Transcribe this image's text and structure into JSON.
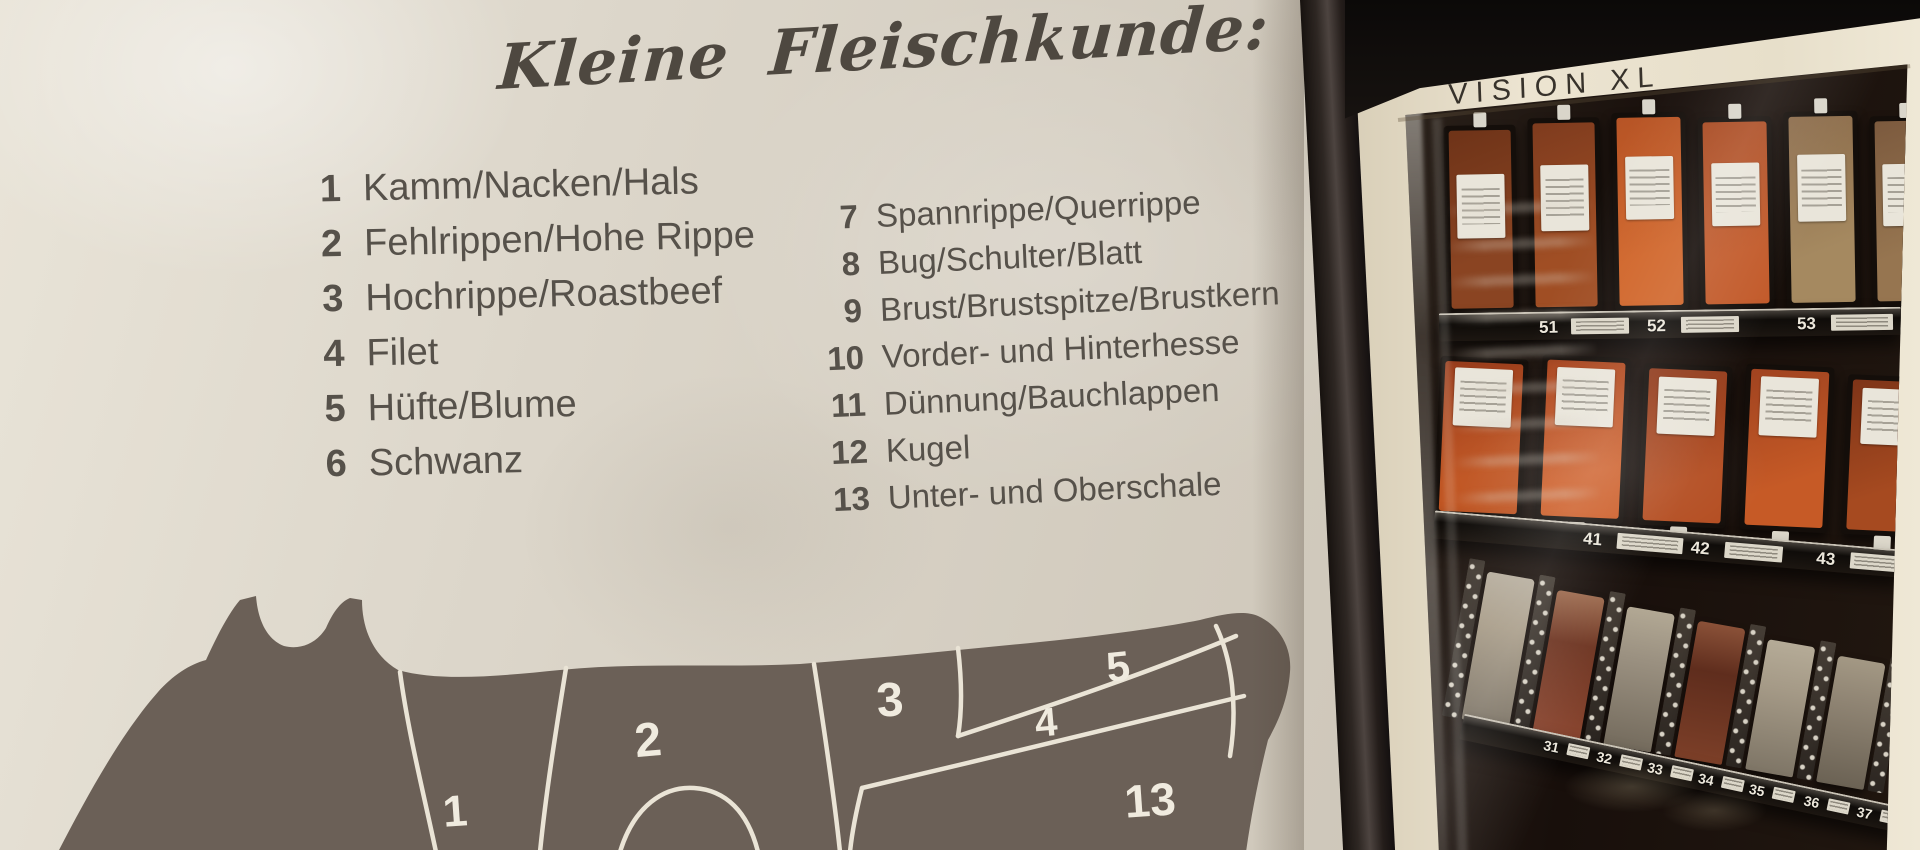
{
  "poster": {
    "title": "Kleine Fleischkunde:",
    "cuts_left": [
      {
        "num": "1",
        "label": "Kamm/Nacken/Hals"
      },
      {
        "num": "2",
        "label": "Fehlrippen/Hohe Rippe"
      },
      {
        "num": "3",
        "label": "Hochrippe/Roastbeef"
      },
      {
        "num": "4",
        "label": "Filet"
      },
      {
        "num": "5",
        "label": "Hüfte/Blume"
      },
      {
        "num": "6",
        "label": "Schwanz"
      }
    ],
    "cuts_right": [
      {
        "num": "7",
        "label": "Spannrippe/Querrippe"
      },
      {
        "num": "8",
        "label": "Bug/Schulter/Blatt"
      },
      {
        "num": "9",
        "label": "Brust/Brustspitze/Brustkern"
      },
      {
        "num": "10",
        "label": "Vorder- und Hinterhesse"
      },
      {
        "num": "11",
        "label": "Dünnung/Bauchlappen"
      },
      {
        "num": "12",
        "label": "Kugel"
      },
      {
        "num": "13",
        "label": "Unter- und Oberschale"
      }
    ],
    "diagram_labels": {
      "s1": "1",
      "s2": "2",
      "s3": "3",
      "s4": "4",
      "s5": "5",
      "s13": "13"
    }
  },
  "machine": {
    "brand": "VISION XL",
    "rows": [
      {
        "slots": [
          {
            "num": "51"
          },
          {
            "num": "52"
          },
          {
            "num": "53"
          }
        ]
      },
      {
        "slots": [
          {
            "num": "41"
          },
          {
            "num": "42"
          },
          {
            "num": "43"
          }
        ]
      },
      {
        "slots": [
          {
            "num": "31"
          },
          {
            "num": "32"
          },
          {
            "num": "33"
          },
          {
            "num": "34"
          },
          {
            "num": "35"
          },
          {
            "num": "36"
          },
          {
            "num": "37"
          }
        ]
      }
    ]
  },
  "colors": {
    "poster_bg": "#dcd6ca",
    "poster_text": "#56514a",
    "cow_body": "#6b6057",
    "divider_line": "#eae4d6",
    "frame_cream": "#ece4d1",
    "door_dark": "#2e2723",
    "glass_dark": "#180f0b",
    "meat_accent": "#a84a22"
  }
}
